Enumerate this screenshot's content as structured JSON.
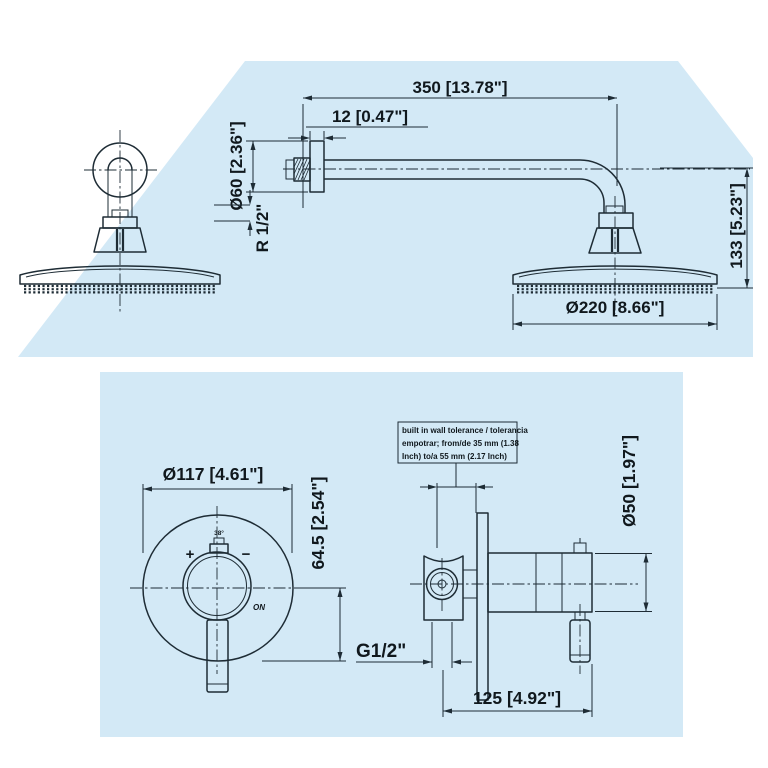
{
  "colors": {
    "panel_blue": "#d3e9f6",
    "line": "#1e2c35",
    "text": "#10181d"
  },
  "top_panel": {
    "dims": {
      "arm_length": "350 [13.78\"]",
      "flange_thickness": "12 [0.47\"]",
      "flange_diameter": "Ø60 [2.36\"]",
      "thread": "R 1/2\"",
      "drop_height": "133 [5.23\"]",
      "head_diameter": "Ø220 [8.66\"]"
    }
  },
  "bottom_panel": {
    "dims": {
      "escutcheon_diameter": "Ø117 [4.61\"]",
      "center_to_bottom": "64.5 [2.54\"]",
      "body_diameter": "Ø50 [1.97\"]",
      "thread": "G1/2\"",
      "body_length": "125 [4.92\"]"
    },
    "knob": {
      "plus": "+",
      "minus": "−",
      "on": "ON",
      "temp": "38°"
    },
    "note": {
      "line1": "built in wall tolerance / tolerancia",
      "line2": "empotrar; from/de 35 mm (1.38",
      "line3": "Inch) to/a 55 mm (2.17 Inch)"
    }
  }
}
